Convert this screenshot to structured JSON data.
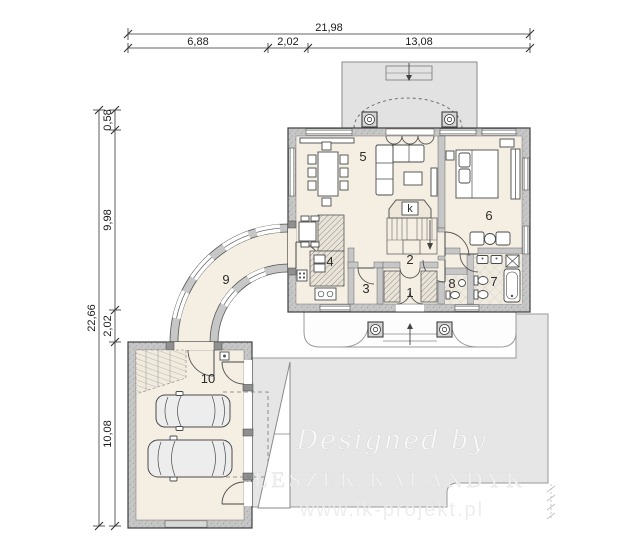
{
  "plan": {
    "dims_top": {
      "total": "21,98",
      "seg1": "6,88",
      "seg2": "2,02",
      "seg3": "13,08"
    },
    "dims_left": {
      "total": "22,66",
      "seg1": "0,58",
      "seg2": "9,98",
      "seg3": "2,02",
      "seg4": "10,08"
    },
    "rooms": {
      "r1": "1",
      "r2": "2",
      "r3": "3",
      "r4": "4",
      "r5": "5",
      "r6": "6",
      "r7": "7",
      "r8": "8",
      "r9": "9",
      "r10": "10",
      "fireplace": "k"
    },
    "watermark": {
      "script": "Designed by",
      "name": "LESZEK KALANDYK",
      "url": "www.lk-projekt.pl"
    },
    "colors": {
      "floor": "#f5efe3",
      "wall_fill": "#c7c7c7",
      "paving": "#e6e6e6",
      "line": "#3f3f3f"
    }
  }
}
